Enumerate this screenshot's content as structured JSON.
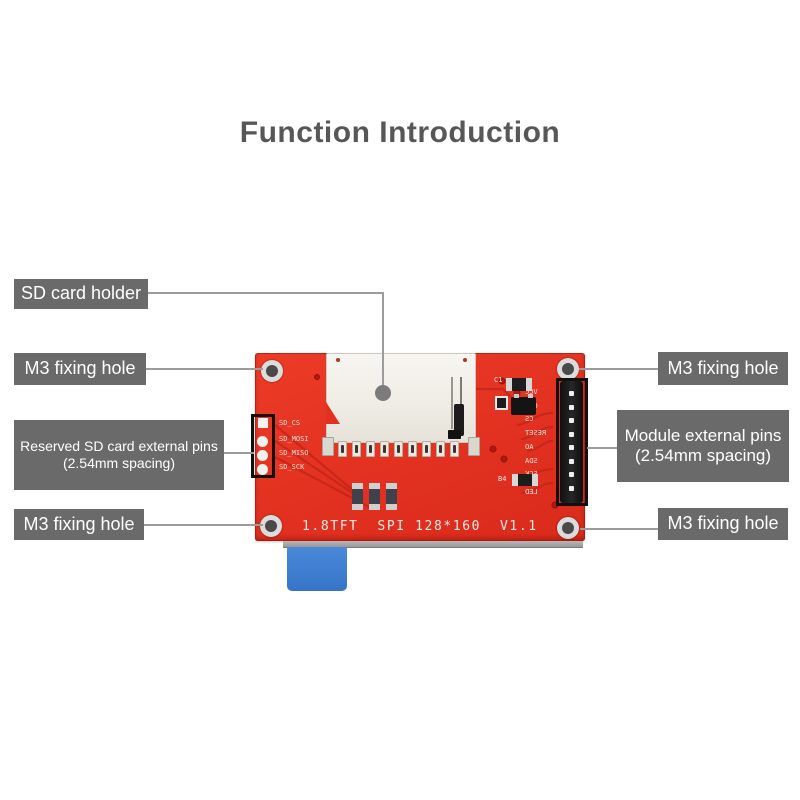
{
  "title": "Function Introduction",
  "callouts": {
    "sd_card_holder": "SD card holder",
    "m3_left_top": "M3 fixing hole",
    "reserved_pins_line1": "Reserved SD card external pins",
    "reserved_pins_line2": "(2.54mm spacing)",
    "m3_left_bottom": "M3 fixing hole",
    "m3_right_top": "M3 fixing hole",
    "module_pins_line1": "Module external pins",
    "module_pins_line2": "(2.54mm spacing)",
    "m3_right_bottom": "M3 fixing hole"
  },
  "board": {
    "silkscreen_text": "1.8TFT  SPI 128*160  V1.1",
    "sd_pin_labels": [
      "SD_CS",
      "SD_MOSI",
      "SD_MISO",
      "SD_SCK"
    ],
    "header_pin_labels": [
      "VCC",
      "GND",
      "CS",
      "RESET",
      "AO",
      "SDA",
      "SCK",
      "LED"
    ],
    "component_labels": {
      "c1": "C1",
      "b4": "B4"
    }
  },
  "colors": {
    "pcb_red": "#e23120",
    "label_gray": "#6a6a6a",
    "callout_line": "#9c9c9c",
    "ribbon_blue": "#3b7ed2",
    "title_gray": "#575757"
  }
}
